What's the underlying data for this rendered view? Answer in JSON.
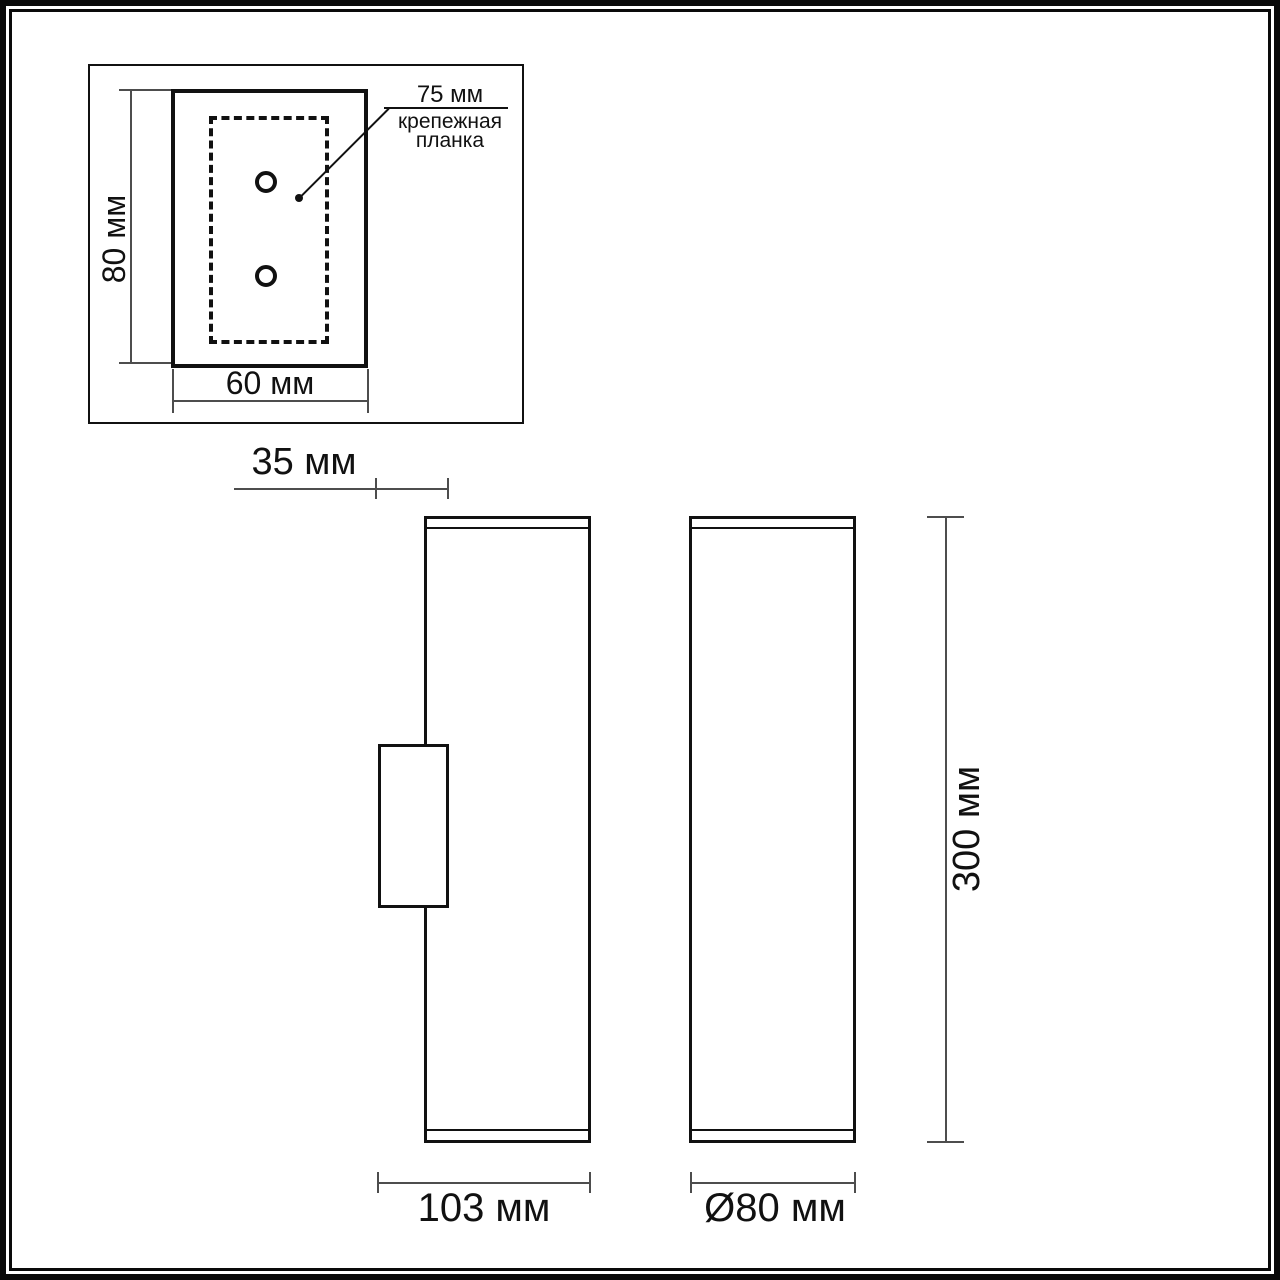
{
  "drawing": {
    "detail_view": {
      "height_label": "80 мм",
      "width_label": "60 мм",
      "annotation_dim": "75 мм",
      "annotation_name": "крепежная\nпланка"
    },
    "side_view": {
      "depth_label": "35 мм",
      "width_label": "103 мм"
    },
    "front_view": {
      "height_label": "300 мм",
      "diameter_label": "Ø80 мм"
    }
  },
  "colors": {
    "ink": "#111111",
    "dim_line": "#4d4d4d",
    "background": "#ffffff"
  }
}
